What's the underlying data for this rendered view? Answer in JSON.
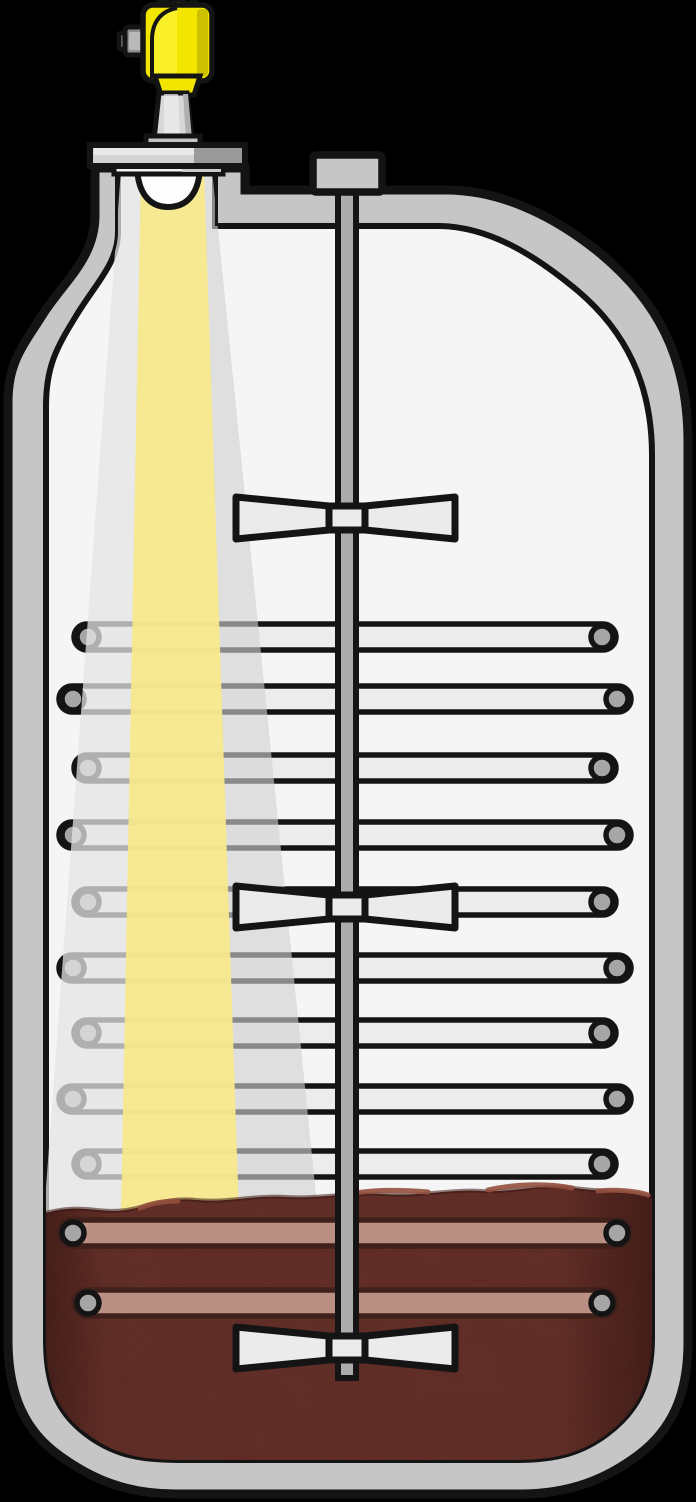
{
  "scene": {
    "width": 696,
    "height": 1502,
    "background": "#000000",
    "description_name": "radar-level-measurement-in-agitated-vessel"
  },
  "colors": {
    "scene_bg": "#000000",
    "outline": "#141414",
    "vessel_wall": "#c6c6c6",
    "vessel_interior": "#f5f5f5",
    "sensor_yellow": "#f2e600",
    "sensor_yellow_bright": "#fbf12e",
    "sensor_yellow_dark": "#cdc000",
    "metal_light": "#d8d8d8",
    "metal_mid": "#adadad",
    "metal_dark": "#8f8f8f",
    "flange_light": "#d3d3d3",
    "flange_dark": "#9a9a9a",
    "flange_bevel": "#e9e9e9",
    "gasket": "#f2f2f2",
    "beam_yellow": "rgba(247,233,140,0.95)",
    "beam_gray": "rgba(210,210,210,0.62)",
    "beam_gray_light": "rgba(255,255,255,0.32)",
    "shaft_fill": "#acacac",
    "blade_fill": "#ebebeb",
    "coil_fill": "#ececec",
    "coil_cap": "#a6a6a6",
    "dome_fill": "#fdfdfd",
    "liquid": "#612c26",
    "liquid_dark": "#3f1b16",
    "liquid_highlight": "#93503f",
    "submerged_coil_fill": "#bb9084",
    "submerged_coil_edge": "#40201a"
  },
  "beam": {
    "y_top": 170,
    "y_bottom": 1215,
    "wide": {
      "top": [
        121,
        212
      ],
      "bottom": [
        44,
        318
      ]
    },
    "narrow": {
      "top": [
        141,
        204
      ],
      "bottom": [
        121,
        239
      ]
    }
  },
  "agitator": {
    "blade_count": 3,
    "blade_centers_y": [
      518,
      907,
      1348
    ],
    "blade_tip_x": [
      233,
      458
    ],
    "hub_x": [
      329,
      365
    ],
    "blade_tip_half_h": 21,
    "hub_half_h": 12,
    "shaft_x": 347,
    "shaft_top_y": 190,
    "shaft_bottom_y": 1378,
    "mount_block": {
      "x": 313,
      "y": 155,
      "w": 69,
      "h": 37
    }
  },
  "coils": {
    "row_count": 11,
    "tube_height": 26,
    "rows": [
      {
        "y": 637,
        "left": 88,
        "right": 602,
        "submerged": false
      },
      {
        "y": 699,
        "left": 73,
        "right": 617,
        "submerged": false
      },
      {
        "y": 768,
        "left": 88,
        "right": 602,
        "submerged": false
      },
      {
        "y": 835,
        "left": 73,
        "right": 617,
        "submerged": false
      },
      {
        "y": 902,
        "left": 88,
        "right": 602,
        "submerged": false
      },
      {
        "y": 968,
        "left": 73,
        "right": 617,
        "submerged": false
      },
      {
        "y": 1033,
        "left": 88,
        "right": 602,
        "submerged": false
      },
      {
        "y": 1099,
        "left": 73,
        "right": 617,
        "submerged": false
      },
      {
        "y": 1164,
        "left": 88,
        "right": 602,
        "submerged": false
      },
      {
        "y": 1233,
        "left": 73,
        "right": 617,
        "submerged": true
      },
      {
        "y": 1303,
        "left": 88,
        "right": 602,
        "submerged": true
      }
    ]
  },
  "sensor": {
    "fin_count": 3
  },
  "liquid": {
    "surface_y": 1200,
    "bottom_y": 1460
  }
}
